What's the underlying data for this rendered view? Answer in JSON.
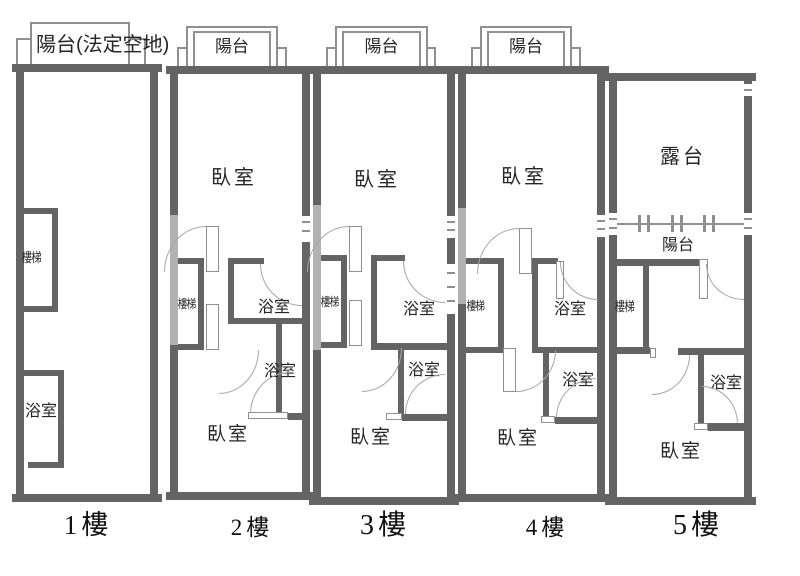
{
  "title": "apartment-floor-plans",
  "colors": {
    "wall_dark": "#646464",
    "wall_light": "#b2b2b2",
    "line": "#8f8f8f",
    "text": "#262626"
  },
  "floors": [
    {
      "caption": "1樓",
      "balcony": "陽台(法定空地)",
      "labels": {
        "stairs": "樓梯",
        "bath": "浴室"
      }
    },
    {
      "caption": "2樓",
      "balcony": "陽台",
      "labels": {
        "bedroom_top": "臥室",
        "stairs": "樓梯",
        "bath_upper": "浴室",
        "bath_lower": "浴室",
        "bedroom_bottom": "臥室"
      }
    },
    {
      "caption": "3樓",
      "balcony": "陽台",
      "labels": {
        "bedroom_top": "臥室",
        "stairs": "樓梯",
        "bath_upper": "浴室",
        "bath_lower": "浴室",
        "bedroom_bottom": "臥室"
      }
    },
    {
      "caption": "4樓",
      "balcony": "陽台",
      "labels": {
        "bedroom_top": "臥室",
        "stairs": "樓梯",
        "bath_upper": "浴室",
        "bath_lower": "浴室",
        "bedroom_bottom": "臥室"
      }
    },
    {
      "caption": "5樓",
      "labels": {
        "terrace": "露台",
        "balcony": "陽台",
        "stairs": "樓梯",
        "bath": "浴室",
        "bedroom": "臥室"
      }
    }
  ]
}
